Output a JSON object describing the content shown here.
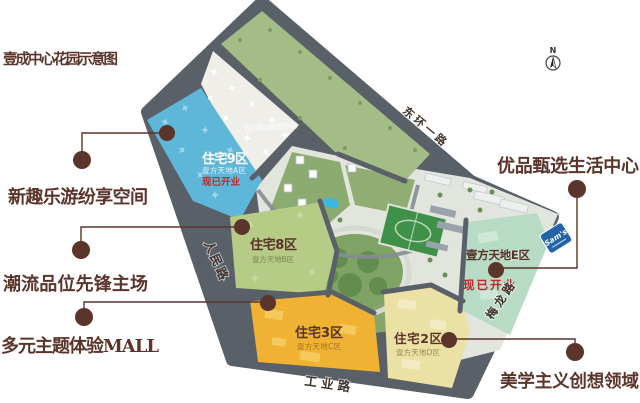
{
  "header": {
    "title": "壹成中心花园示意图"
  },
  "map": {
    "disclaimer": "仅为意向规划示意",
    "compass_label": "N",
    "sams_badge": "Sam's",
    "roads": {
      "northeast": "东环一路",
      "west": "人民路",
      "south": "工业路",
      "southeast": "梅龙路"
    },
    "zones": {
      "zone9": {
        "name": "住宅9区",
        "subtitle": "壹方天地A区",
        "status": "现已开业",
        "color": "#5eb7d9"
      },
      "zone8": {
        "name": "住宅8区",
        "subtitle": "壹方天地B区",
        "color": "#b6cb86"
      },
      "zone3": {
        "name": "住宅3区",
        "subtitle": "壹方天地C区",
        "color": "#f0b232"
      },
      "zone2": {
        "name": "住宅2区",
        "subtitle": "壹方天地D区",
        "color": "#ebe1a5"
      },
      "zoneE": {
        "name": "壹方天地E区",
        "status": "现已开业",
        "color": "#b7dbc5"
      }
    }
  },
  "callouts": {
    "c1": {
      "text": "新趣乐游纷享空间"
    },
    "c2": {
      "text": "潮流品位先锋主场"
    },
    "c3": {
      "text": "多元主题体验MALL"
    },
    "c4": {
      "text": "优品甄选生活中心"
    },
    "c5": {
      "text": "美学主义创想领域"
    }
  },
  "colors": {
    "accent_maroon": "#5b342b",
    "status_red": "#c0262c",
    "road_gray": "#5a6068",
    "park_green": "#7fa364",
    "pool_blue": "#3db6e0"
  }
}
